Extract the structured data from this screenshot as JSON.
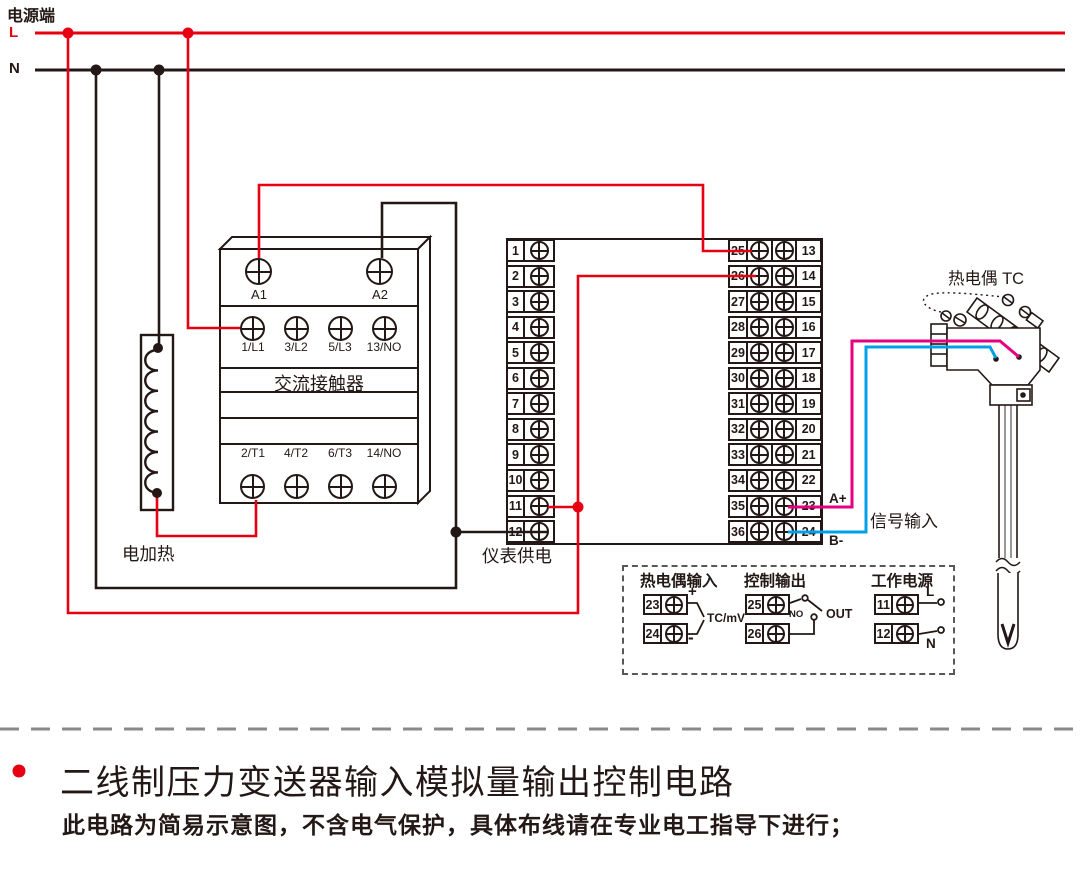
{
  "power": {
    "label": "电源端",
    "live": "L",
    "neutral": "N"
  },
  "contactor": {
    "label": "交流接触器",
    "coil_terminals": [
      "A1",
      "A2"
    ],
    "input_terminals": [
      "1/L1",
      "3/L2",
      "5/L3",
      "13/NO"
    ],
    "output_terminals": [
      "2/T1",
      "4/T2",
      "6/T3",
      "14/NO"
    ]
  },
  "heater": {
    "label": "电加热"
  },
  "meter": {
    "power_label": "仪表供电",
    "left_terminals": [
      "1",
      "2",
      "3",
      "4",
      "5",
      "6",
      "7",
      "8",
      "9",
      "10",
      "11",
      "12"
    ],
    "right_inner_terminals": [
      "25",
      "26",
      "27",
      "28",
      "29",
      "30",
      "31",
      "32",
      "33",
      "34",
      "35",
      "36"
    ],
    "right_outer_terminals": [
      "13",
      "14",
      "15",
      "16",
      "17",
      "18",
      "19",
      "20",
      "21",
      "22",
      "23",
      "24"
    ]
  },
  "signal": {
    "a_plus": "A+",
    "b_minus": "B-",
    "label": "信号输入"
  },
  "thermocouple": {
    "label": "热电偶 TC"
  },
  "legend": {
    "tc_input": {
      "title": "热电偶输入",
      "terminals": [
        "23",
        "24"
      ],
      "plus": "+",
      "minus": "-",
      "range_label": "TC/mV"
    },
    "control_output": {
      "title": "控制输出",
      "terminals": [
        "25",
        "26"
      ],
      "no_label": "NO",
      "out_label": "OUT"
    },
    "working_power": {
      "title": "工作电源",
      "terminals": [
        "11",
        "12"
      ],
      "live": "L",
      "neutral": "N"
    }
  },
  "footer": {
    "title": "二线制压力变送器输入模拟量输出控制电路",
    "note": "此电路为简易示意图，不含电气保护，具体布线请在专业电工指导下进行；"
  },
  "colors": {
    "live_wire": "#e60012",
    "neutral_wire": "#231815",
    "signal_a_wire": "#e4007f",
    "signal_b_wire": "#00a0e9",
    "divider": "#898989"
  }
}
